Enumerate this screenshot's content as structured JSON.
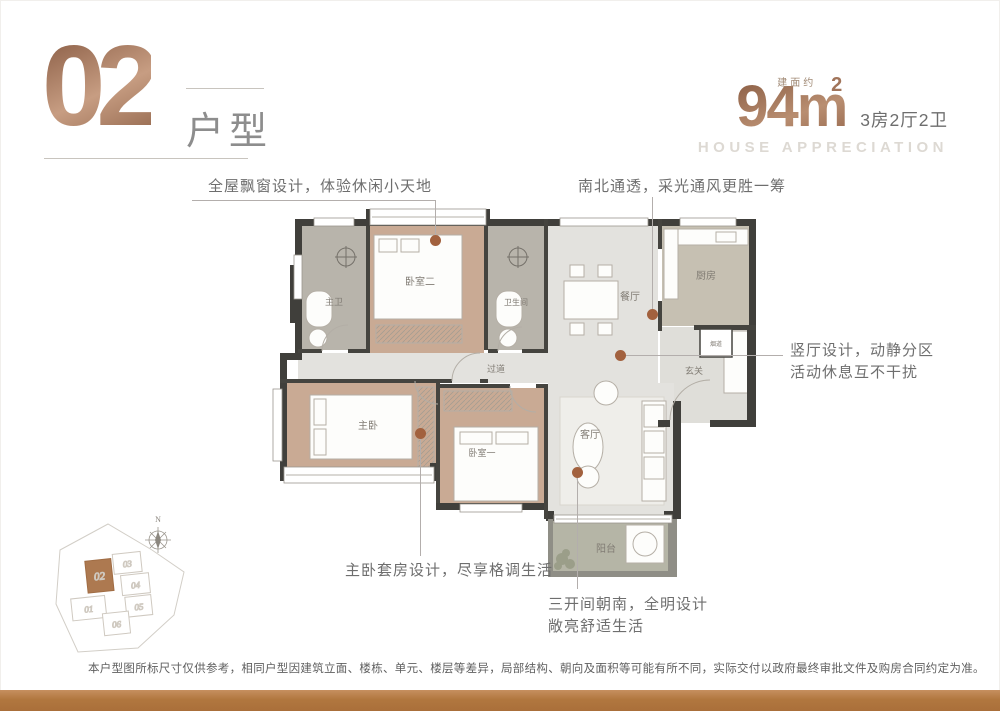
{
  "colors": {
    "bronze_accent": "#a8754e",
    "annotation_dot": "#a2613e",
    "bottom_bar": "#b1773f",
    "wall_dark": "#403f3b",
    "bedroom_floor": "#c9aa94",
    "bath_floor": "#b8b4ab",
    "living_floor": "#e3e2de",
    "balcony_floor": "#b5b5a6"
  },
  "header": {
    "unit_number": "02",
    "unit_suffix": "户型",
    "area_prefix": "建面约",
    "area_value": "94m",
    "area_sup": "2",
    "layout_spec": "3房2厅2卫",
    "tagline_en": "HOUSE APPRECIATION"
  },
  "annotations": {
    "bay_window": "全屋飘窗设计，体验休闲小天地",
    "north_south": "南北通透，采光通风更胜一筹",
    "hall_line1": "竖厅设计，动静分区",
    "hall_line2": "活动休息互不干扰",
    "master_suite": "主卧套房设计，尽享格调生活",
    "south_line1": "三开间朝南，全明设计",
    "south_line2": "敞亮舒适生活"
  },
  "plan": {
    "rooms": {
      "master_bath": "主卫",
      "bedroom2": "卧室二",
      "bathroom": "卫生间",
      "dining": "餐厅",
      "kitchen": "厨房",
      "flue": "烟道",
      "foyer": "玄关",
      "corridor": "过道",
      "master": "主卧",
      "bedroom1": "卧室一",
      "living": "客厅",
      "balcony": "阳台"
    }
  },
  "site_plan": {
    "north_label": "N",
    "highlighted_unit": "02",
    "units": {
      "u01": "01",
      "u02": "02",
      "u03": "03",
      "u04": "04",
      "u05": "05",
      "u06": "06"
    }
  },
  "footer": {
    "disclaimer": "本户型图所标尺寸仅供参考，相同户型因建筑立面、楼栋、单元、楼层等差异，局部结构、朝向及面积等可能有所不同，实际交付以政府最终审批文件及购房合同约定为准。"
  }
}
